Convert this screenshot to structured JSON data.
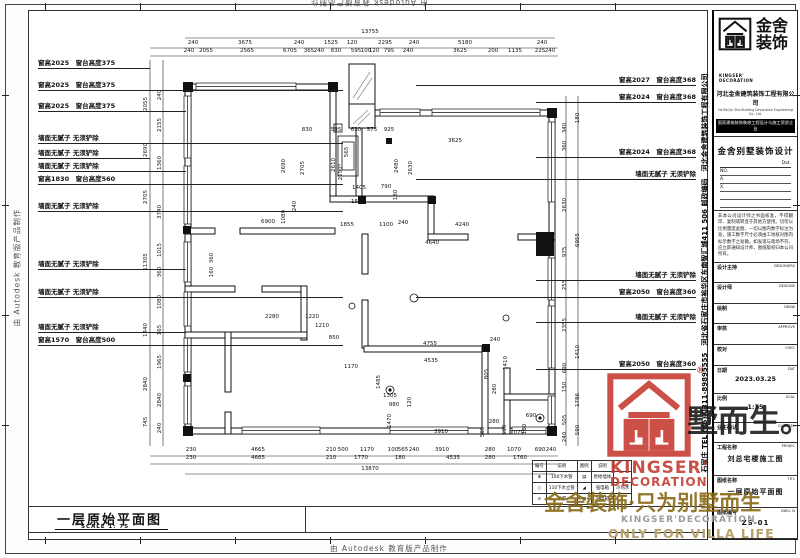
{
  "edge": {
    "stamp": "由 Autodesk 教育版产品制作"
  },
  "sheet_title": {
    "title": "一层原始平面图",
    "scale": "SCALE 1: 75"
  },
  "annotations": {
    "left": [
      {
        "t": "窗高2025　窗台高度375",
        "y": 67,
        "w": 112
      },
      {
        "t": "窗高2025　窗台高度375",
        "y": 89,
        "w": 305
      },
      {
        "t": "窗高2025　窗台高度375",
        "y": 110,
        "w": 148
      },
      {
        "t": "墙面无腻子 无须铲除",
        "y": 142,
        "w": 305
      },
      {
        "t": "墙面无腻子 无须铲除",
        "y": 157,
        "w": 112
      },
      {
        "t": "墙面无腻子 无须铲除",
        "y": 170,
        "w": 148
      },
      {
        "t": "窗高1830　窗台高度560",
        "y": 183,
        "w": 305
      },
      {
        "t": "墙面无腻子 无须铲除",
        "y": 210,
        "w": 305
      },
      {
        "t": "墙面无腻子 无须铲除",
        "y": 268,
        "w": 148
      },
      {
        "t": "墙面无腻子 无须铲除",
        "y": 296,
        "w": 305
      },
      {
        "t": "墙面无腻子 无须铲除",
        "y": 331,
        "w": 148
      },
      {
        "t": "窗高1570　窗台高度500",
        "y": 344,
        "w": 305
      }
    ],
    "right": [
      {
        "t": "窗高2027　窗台高度368",
        "y": 84,
        "w": 280
      },
      {
        "t": "窗高2024　窗台高度368",
        "y": 101,
        "w": 160
      },
      {
        "t": "窗高2024　窗台高度368",
        "y": 156,
        "w": 160
      },
      {
        "t": "墙面无腻子 无须铲除",
        "y": 178,
        "w": 280
      },
      {
        "t": "墙面无腻子 无须铲除",
        "y": 279,
        "w": 160
      },
      {
        "t": "窗高2050　窗台高度360",
        "y": 296,
        "w": 280
      },
      {
        "t": "墙面无腻子 无须铲除",
        "y": 321,
        "w": 160
      },
      {
        "t": "窗高2050　窗台高度360",
        "y": 368,
        "w": 160
      }
    ]
  },
  "dim_labels": [
    {
      "t": "13755",
      "x": 370,
      "y": 33
    },
    {
      "t": "240",
      "x": 193,
      "y": 44
    },
    {
      "t": "3675",
      "x": 245,
      "y": 44
    },
    {
      "t": "240",
      "x": 299,
      "y": 44
    },
    {
      "t": "1525",
      "x": 331,
      "y": 44
    },
    {
      "t": "120",
      "x": 352,
      "y": 44
    },
    {
      "t": "2295",
      "x": 385,
      "y": 44
    },
    {
      "t": "240",
      "x": 414,
      "y": 44
    },
    {
      "t": "5180",
      "x": 465,
      "y": 44
    },
    {
      "t": "240",
      "x": 542,
      "y": 44
    },
    {
      "t": "240",
      "x": 189,
      "y": 52
    },
    {
      "t": "2055",
      "x": 206,
      "y": 52
    },
    {
      "t": "2565",
      "x": 247,
      "y": 52
    },
    {
      "t": "6705",
      "x": 290,
      "y": 52
    },
    {
      "t": "365",
      "x": 309,
      "y": 52
    },
    {
      "t": "240",
      "x": 319,
      "y": 52
    },
    {
      "t": "830",
      "x": 336,
      "y": 52
    },
    {
      "t": "595",
      "x": 356,
      "y": 52
    },
    {
      "t": "100",
      "x": 366,
      "y": 52
    },
    {
      "t": "120",
      "x": 374,
      "y": 52
    },
    {
      "t": "795",
      "x": 389,
      "y": 52
    },
    {
      "t": "240",
      "x": 408,
      "y": 52
    },
    {
      "t": "3625",
      "x": 460,
      "y": 52
    },
    {
      "t": "200",
      "x": 493,
      "y": 52
    },
    {
      "t": "1135",
      "x": 515,
      "y": 52
    },
    {
      "t": "225",
      "x": 540,
      "y": 52
    },
    {
      "t": "240",
      "x": 550,
      "y": 52
    },
    {
      "t": "230",
      "x": 191,
      "y": 451
    },
    {
      "t": "4665",
      "x": 258,
      "y": 451
    },
    {
      "t": "210",
      "x": 331,
      "y": 451
    },
    {
      "t": "500",
      "x": 343,
      "y": 451
    },
    {
      "t": "1170",
      "x": 367,
      "y": 451
    },
    {
      "t": "100",
      "x": 393,
      "y": 451
    },
    {
      "t": "565",
      "x": 403,
      "y": 451
    },
    {
      "t": "240",
      "x": 414,
      "y": 451
    },
    {
      "t": "3910",
      "x": 442,
      "y": 451
    },
    {
      "t": "280",
      "x": 490,
      "y": 451
    },
    {
      "t": "1070",
      "x": 514,
      "y": 451
    },
    {
      "t": "690",
      "x": 540,
      "y": 451
    },
    {
      "t": "240",
      "x": 551,
      "y": 451
    },
    {
      "t": "230",
      "x": 191,
      "y": 459
    },
    {
      "t": "4665",
      "x": 258,
      "y": 459
    },
    {
      "t": "210",
      "x": 331,
      "y": 459
    },
    {
      "t": "1770",
      "x": 361,
      "y": 459
    },
    {
      "t": "180",
      "x": 400,
      "y": 459
    },
    {
      "t": "4535",
      "x": 453,
      "y": 459
    },
    {
      "t": "280",
      "x": 490,
      "y": 459
    },
    {
      "t": "1760",
      "x": 520,
      "y": 459
    },
    {
      "t": "13870",
      "x": 370,
      "y": 470
    },
    {
      "t": "2055",
      "x": 146,
      "y": 104,
      "r": 1
    },
    {
      "t": "2690",
      "x": 146,
      "y": 150,
      "r": 1
    },
    {
      "t": "2705",
      "x": 146,
      "y": 197,
      "r": 1
    },
    {
      "t": "11305",
      "x": 146,
      "y": 262,
      "r": 1
    },
    {
      "t": "1440",
      "x": 146,
      "y": 330,
      "r": 1
    },
    {
      "t": "2840",
      "x": 146,
      "y": 384,
      "r": 1
    },
    {
      "t": "745",
      "x": 146,
      "y": 422,
      "r": 1
    },
    {
      "t": "240",
      "x": 160,
      "y": 95,
      "r": 1
    },
    {
      "t": "2155",
      "x": 160,
      "y": 125,
      "r": 1
    },
    {
      "t": "1360",
      "x": 160,
      "y": 163,
      "r": 1
    },
    {
      "t": "3740",
      "x": 160,
      "y": 212,
      "r": 1
    },
    {
      "t": "1015",
      "x": 160,
      "y": 250,
      "r": 1
    },
    {
      "t": "360",
      "x": 160,
      "y": 272,
      "r": 1
    },
    {
      "t": "1080",
      "x": 160,
      "y": 302,
      "r": 1
    },
    {
      "t": "165",
      "x": 160,
      "y": 330,
      "r": 1
    },
    {
      "t": "1965",
      "x": 160,
      "y": 362,
      "r": 1
    },
    {
      "t": "2840",
      "x": 160,
      "y": 400,
      "r": 1
    },
    {
      "t": "240",
      "x": 160,
      "y": 428,
      "r": 1
    },
    {
      "t": "340",
      "x": 565,
      "y": 128,
      "r": 1
    },
    {
      "t": "360",
      "x": 565,
      "y": 146,
      "r": 1
    },
    {
      "t": "2630",
      "x": 565,
      "y": 205,
      "r": 1
    },
    {
      "t": "975",
      "x": 565,
      "y": 252,
      "r": 1
    },
    {
      "t": "255",
      "x": 565,
      "y": 285,
      "r": 1
    },
    {
      "t": "2355",
      "x": 565,
      "y": 325,
      "r": 1
    },
    {
      "t": "690",
      "x": 565,
      "y": 368,
      "r": 1
    },
    {
      "t": "150",
      "x": 565,
      "y": 387,
      "r": 1
    },
    {
      "t": "505",
      "x": 565,
      "y": 420,
      "r": 1
    },
    {
      "t": "240",
      "x": 565,
      "y": 437,
      "r": 1
    },
    {
      "t": "180",
      "x": 578,
      "y": 118,
      "r": 1
    },
    {
      "t": "6955",
      "x": 578,
      "y": 240,
      "r": 1
    },
    {
      "t": "1410",
      "x": 578,
      "y": 352,
      "r": 1
    },
    {
      "t": "1786",
      "x": 578,
      "y": 400,
      "r": 1
    },
    {
      "t": "590",
      "x": 578,
      "y": 430,
      "r": 1
    },
    {
      "t": "830",
      "x": 307,
      "y": 131
    },
    {
      "t": "595",
      "x": 336,
      "y": 131
    },
    {
      "t": "630",
      "x": 356,
      "y": 131
    },
    {
      "t": "575",
      "x": 372,
      "y": 131
    },
    {
      "t": "925",
      "x": 389,
      "y": 131
    },
    {
      "t": "3625",
      "x": 455,
      "y": 142
    },
    {
      "t": "2690",
      "x": 284,
      "y": 166,
      "r": 1
    },
    {
      "t": "2705",
      "x": 303,
      "y": 168,
      "r": 1
    },
    {
      "t": "2610",
      "x": 334,
      "y": 165,
      "r": 1
    },
    {
      "t": "565",
      "x": 347,
      "y": 152,
      "r": 1
    },
    {
      "t": "2190°",
      "x": 341,
      "y": 172,
      "r": 1
    },
    {
      "t": "2480",
      "x": 397,
      "y": 166,
      "r": 1
    },
    {
      "t": "2630",
      "x": 411,
      "y": 168,
      "r": 1
    },
    {
      "t": "1405",
      "x": 359,
      "y": 189
    },
    {
      "t": "790",
      "x": 386,
      "y": 188
    },
    {
      "t": "180",
      "x": 396,
      "y": 195,
      "r": 1
    },
    {
      "t": "1520",
      "x": 358,
      "y": 203
    },
    {
      "t": "240",
      "x": 295,
      "y": 206,
      "r": 1
    },
    {
      "t": "1080",
      "x": 284,
      "y": 217,
      "r": 1
    },
    {
      "t": "6900",
      "x": 268,
      "y": 223
    },
    {
      "t": "1855",
      "x": 347,
      "y": 226
    },
    {
      "t": "1100",
      "x": 386,
      "y": 226
    },
    {
      "t": "240",
      "x": 403,
      "y": 224
    },
    {
      "t": "4240",
      "x": 462,
      "y": 226
    },
    {
      "t": "4640",
      "x": 432,
      "y": 244
    },
    {
      "t": "360",
      "x": 212,
      "y": 258,
      "r": 1
    },
    {
      "t": "160",
      "x": 212,
      "y": 272,
      "r": 1
    },
    {
      "t": "2280",
      "x": 272,
      "y": 318
    },
    {
      "t": "1220",
      "x": 312,
      "y": 318
    },
    {
      "t": "1210",
      "x": 322,
      "y": 327
    },
    {
      "t": "850",
      "x": 334,
      "y": 339
    },
    {
      "t": "4755",
      "x": 430,
      "y": 345
    },
    {
      "t": "240",
      "x": 495,
      "y": 341
    },
    {
      "t": "4535",
      "x": 431,
      "y": 362
    },
    {
      "t": "1410",
      "x": 506,
      "y": 363,
      "r": 1
    },
    {
      "t": "805",
      "x": 487,
      "y": 374,
      "r": 1
    },
    {
      "t": "280",
      "x": 495,
      "y": 389,
      "r": 1
    },
    {
      "t": "1485",
      "x": 379,
      "y": 382,
      "r": 1
    },
    {
      "t": "1170",
      "x": 351,
      "y": 368
    },
    {
      "t": "1305",
      "x": 390,
      "y": 397
    },
    {
      "t": "980",
      "x": 394,
      "y": 406
    },
    {
      "t": "120",
      "x": 410,
      "y": 402,
      "r": 1
    },
    {
      "t": "1470",
      "x": 390,
      "y": 421,
      "r": 1
    },
    {
      "t": "3910",
      "x": 441,
      "y": 433
    },
    {
      "t": "505",
      "x": 483,
      "y": 432,
      "r": 1
    },
    {
      "t": "280",
      "x": 494,
      "y": 423
    },
    {
      "t": "590",
      "x": 505,
      "y": 430,
      "r": 1
    },
    {
      "t": "1070",
      "x": 517,
      "y": 434
    },
    {
      "t": "180",
      "x": 525,
      "y": 429,
      "r": 1
    },
    {
      "t": "690",
      "x": 531,
      "y": 417
    }
  ],
  "legend": {
    "headers": [
      "编号",
      "说明",
      "图例",
      "说明",
      ""
    ],
    "rows": [
      [
        "⊕",
        "100下水管",
        "▤",
        "原始墙体",
        ""
      ],
      [
        "○",
        "110下水立管",
        "◢",
        "强电箱",
        "冷热水"
      ],
      [
        "⊙",
        "地漏",
        "▣",
        "弱电箱",
        ""
      ]
    ]
  },
  "title_block": {
    "logo": {
      "cn1": "金舍",
      "cn2": "装饰",
      "en1": "KINGSER'",
      "en2": "DECORATION"
    },
    "company": "河北金舍建筑装饰工程有限公司",
    "company_en": "He Bei Jin She Building Decoration Engineering Co., Ltd.",
    "qualification": "国家建筑装饰装修工程设计与施工资质企业",
    "brand_line": "金舍别墅装饰设计",
    "dat_label": "Dat.",
    "no_lines": [
      "NO.",
      "A.",
      "X.",
      "",
      ""
    ],
    "note": "非本公司设计师之书面核准，不得翻印、复制或转变于其他方使用。切勿以比例量度此图，一切以图内数字标注为准，施工数字尺寸必须由工地核对图内标示数字之准确，如发现与现场不符，应立即通知设计师，图纸版权归本公司所有。",
    "fields": [
      {
        "label": "设计主持",
        "en": "DESIGNERS",
        "value": ""
      },
      {
        "label": "设计师",
        "en": "DESIGNE",
        "value": ""
      },
      {
        "label": "绘制",
        "en": "DRAW",
        "value": ""
      },
      {
        "label": "审核",
        "en": "APPROVE",
        "value": ""
      },
      {
        "label": "校对",
        "en": "CHEC",
        "value": ""
      },
      {
        "label": "日期",
        "en": "DAT",
        "value": "2023.03.25"
      },
      {
        "label": "比例",
        "en": "SCAL",
        "value": "1:75"
      },
      {
        "label": "业主确认",
        "en": "CLIENTEL",
        "value": ""
      },
      {
        "label": "工程名称",
        "en": "PROJEC",
        "value": "刘总宅楼施工图",
        "big": true
      },
      {
        "label": "图纸名称",
        "en": "TITL",
        "value": "一层原始平面图",
        "big": true
      },
      {
        "label": "图纸编号",
        "en": "DWG. N",
        "value": "ZS-01",
        "big": true
      }
    ],
    "contact_vertical": "石家庄 TEL (86) 0311-89895555　河北省石家庄市裕华区东南智汇城411 506 邮政编码　河北金舍建筑装饰工程有限公司"
  },
  "stamp": {
    "en1": "KINGSER'",
    "en2": "DECORATION",
    "reg": "®"
  },
  "watermark": {
    "gold": "金舍裝飾·只为别墅而生",
    "dark": "墅而生。",
    "en_small": "KINGSER'DECORATION",
    "en_big": "ONLY FOR VILLA LIFE"
  }
}
